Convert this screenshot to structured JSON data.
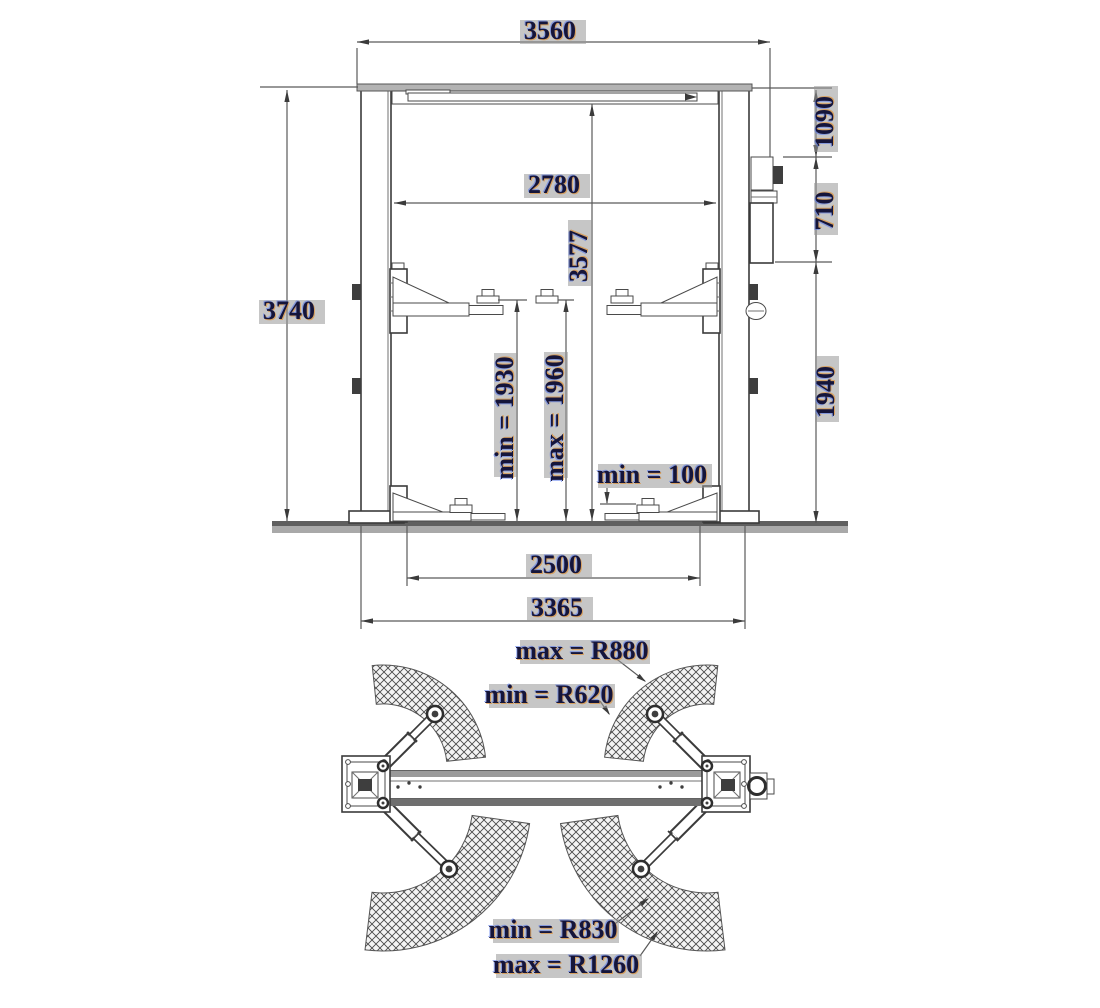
{
  "front_view": {
    "dims": {
      "overall_width": "3560",
      "total_height": "3740",
      "clear_width": "2780",
      "column_height": "3577",
      "top_offset": "1090",
      "motor_offset": "710",
      "lower_height": "1940",
      "lift_min": "min = 1930",
      "lift_max": "max = 1960",
      "pad_min_height": "min = 100",
      "drive_through": "2500",
      "base_width": "3365"
    }
  },
  "top_view": {
    "dims": {
      "short_arm_max_radius": "max = R880",
      "short_arm_min_radius": "min = R620",
      "long_arm_min_radius": "min = R830",
      "long_arm_max_radius": "max = R1260"
    }
  },
  "colors": {
    "line": "#3b3b3b",
    "dimension_line": "#5a5a5a",
    "dimension_text": "#15153a",
    "label_shadow": "#979797",
    "hatch": "#4a4a4a",
    "background": "#ffffff"
  }
}
